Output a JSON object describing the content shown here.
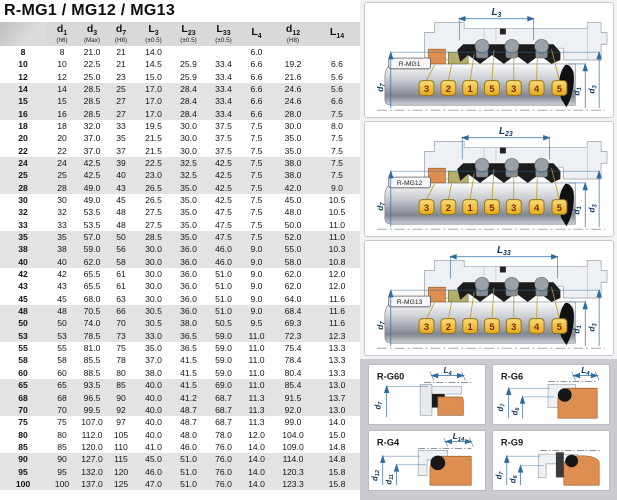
{
  "title": "R-MG1 / MG12 / MG13",
  "table": {
    "headers": [
      {
        "sym": "",
        "sub": "",
        "note": ""
      },
      {
        "sym": "d",
        "sub": "1",
        "note": "(h6)"
      },
      {
        "sym": "d",
        "sub": "3",
        "note": "(Max)"
      },
      {
        "sym": "d",
        "sub": "7",
        "note": "(H8)"
      },
      {
        "sym": "L",
        "sub": "3",
        "note": "(±0.5)"
      },
      {
        "sym": "L",
        "sub": "23",
        "note": "(±0.5)"
      },
      {
        "sym": "L",
        "sub": "33",
        "note": "(±0.5)"
      },
      {
        "sym": "L",
        "sub": "4",
        "note": ""
      },
      {
        "sym": "d",
        "sub": "12",
        "note": "(H8)"
      },
      {
        "sym": "L",
        "sub": "14",
        "note": ""
      }
    ],
    "rows": [
      [
        "8",
        "8",
        "21.0",
        "21",
        "14.0",
        "",
        "",
        "6.0",
        "",
        ""
      ],
      [
        "10",
        "10",
        "22.5",
        "21",
        "14.5",
        "25.9",
        "33.4",
        "6.6",
        "19.2",
        "6.6"
      ],
      [
        "12",
        "12",
        "25.0",
        "23",
        "15.0",
        "25.9",
        "33.4",
        "6.6",
        "21.6",
        "5.6"
      ],
      [
        "14",
        "14",
        "28.5",
        "25",
        "17.0",
        "28.4",
        "33.4",
        "6.6",
        "24.6",
        "5.6"
      ],
      [
        "15",
        "15",
        "28.5",
        "27",
        "17.0",
        "28.4",
        "33.4",
        "6.6",
        "24.6",
        "6.6"
      ],
      [
        "16",
        "16",
        "28.5",
        "27",
        "17.0",
        "28.4",
        "33.4",
        "6.6",
        "28.0",
        "7.5"
      ],
      [
        "18",
        "18",
        "32.0",
        "33",
        "19.5",
        "30.0",
        "37.5",
        "7.5",
        "30.0",
        "8.0"
      ],
      [
        "20",
        "20",
        "37.0",
        "35",
        "21.5",
        "30.0",
        "37.5",
        "7.5",
        "35.0",
        "7.5"
      ],
      [
        "22",
        "22",
        "37.0",
        "37",
        "21.5",
        "30.0",
        "37.5",
        "7.5",
        "35.0",
        "7.5"
      ],
      [
        "24",
        "24",
        "42.5",
        "39",
        "22.5",
        "32.5",
        "42.5",
        "7.5",
        "38.0",
        "7.5"
      ],
      [
        "25",
        "25",
        "42.5",
        "40",
        "23.0",
        "32.5",
        "42.5",
        "7.5",
        "38.0",
        "7.5"
      ],
      [
        "28",
        "28",
        "49.0",
        "43",
        "26.5",
        "35.0",
        "42.5",
        "7.5",
        "42.0",
        "9.0"
      ],
      [
        "30",
        "30",
        "49.0",
        "45",
        "26.5",
        "35.0",
        "42.5",
        "7.5",
        "45.0",
        "10.5"
      ],
      [
        "32",
        "32",
        "53.5",
        "48",
        "27.5",
        "35.0",
        "47.5",
        "7.5",
        "48.0",
        "10.5"
      ],
      [
        "33",
        "33",
        "53.5",
        "48",
        "27.5",
        "35.0",
        "47.5",
        "7.5",
        "50.0",
        "11.0"
      ],
      [
        "35",
        "35",
        "57.0",
        "50",
        "28.5",
        "35.0",
        "47.5",
        "7.5",
        "52.0",
        "11.0"
      ],
      [
        "38",
        "38",
        "59.0",
        "56",
        "30.0",
        "36.0",
        "46.0",
        "9.0",
        "55.0",
        "10.3"
      ],
      [
        "40",
        "40",
        "62.0",
        "58",
        "30.0",
        "36.0",
        "46.0",
        "9.0",
        "58.0",
        "10.8"
      ],
      [
        "42",
        "42",
        "65.5",
        "61",
        "30.0",
        "36.0",
        "51.0",
        "9.0",
        "62.0",
        "12.0"
      ],
      [
        "43",
        "43",
        "65.5",
        "61",
        "30.0",
        "36.0",
        "51.0",
        "9.0",
        "62.0",
        "12.0"
      ],
      [
        "45",
        "45",
        "68.0",
        "63",
        "30.0",
        "36.0",
        "51.0",
        "9.0",
        "64.0",
        "11.6"
      ],
      [
        "48",
        "48",
        "70.5",
        "66",
        "30.5",
        "36.0",
        "51.0",
        "9.0",
        "68.4",
        "11.6"
      ],
      [
        "50",
        "50",
        "74.0",
        "70",
        "30.5",
        "38.0",
        "50.5",
        "9.5",
        "69.3",
        "11.6"
      ],
      [
        "53",
        "53",
        "78.5",
        "73",
        "33.0",
        "36.5",
        "59.0",
        "11.0",
        "72.3",
        "12.3"
      ],
      [
        "55",
        "55",
        "81.0",
        "75",
        "35.0",
        "36.5",
        "59.0",
        "11.0",
        "75.4",
        "13.3"
      ],
      [
        "58",
        "58",
        "85.5",
        "78",
        "37.0",
        "41.5",
        "59.0",
        "11.0",
        "78.4",
        "13.3"
      ],
      [
        "60",
        "60",
        "88.5",
        "80",
        "38.0",
        "41.5",
        "59.0",
        "11.0",
        "80.4",
        "13.3"
      ],
      [
        "65",
        "65",
        "93.5",
        "85",
        "40.0",
        "41.5",
        "69.0",
        "11.0",
        "85.4",
        "13.0"
      ],
      [
        "68",
        "68",
        "96.5",
        "90",
        "40.0",
        "41.2",
        "68.7",
        "11.3",
        "91.5",
        "13.7"
      ],
      [
        "70",
        "70",
        "99.5",
        "92",
        "40.0",
        "48.7",
        "68.7",
        "11.3",
        "92.0",
        "13.0"
      ],
      [
        "75",
        "75",
        "107.0",
        "97",
        "40.0",
        "48.7",
        "68.7",
        "11.3",
        "99.0",
        "14.0"
      ],
      [
        "80",
        "80",
        "112.0",
        "105",
        "40.0",
        "48.0",
        "78.0",
        "12.0",
        "104.0",
        "15.0"
      ],
      [
        "85",
        "85",
        "120.0",
        "110",
        "41.0",
        "46.0",
        "76.0",
        "14.0",
        "109.0",
        "14.8"
      ],
      [
        "90",
        "90",
        "127.0",
        "115",
        "45.0",
        "51.0",
        "76.0",
        "14.0",
        "114.0",
        "14.8"
      ],
      [
        "95",
        "95",
        "132.0",
        "120",
        "46.0",
        "51.0",
        "76.0",
        "14.0",
        "120.3",
        "15.8"
      ],
      [
        "100",
        "100",
        "137.0",
        "125",
        "47.0",
        "51.0",
        "76.0",
        "14.0",
        "123.3",
        "15.8"
      ]
    ]
  },
  "diagrams": [
    {
      "label": "R-MG1",
      "dim_sym": "L",
      "dim_sub": "3",
      "left_sym": "d",
      "left_sub": "7",
      "r1_sym": "d",
      "r1_sub": "1",
      "r2_sym": "d",
      "r2_sub": "3",
      "balloons": [
        "3",
        "2",
        "1",
        "5",
        "3",
        "4",
        "5"
      ]
    },
    {
      "label": "R-MG12",
      "dim_sym": "L",
      "dim_sub": "23",
      "left_sym": "d",
      "left_sub": "7",
      "r1_sym": "d",
      "r1_sub": "1",
      "r2_sym": "d",
      "r2_sub": "3",
      "balloons": [
        "3",
        "2",
        "1",
        "5",
        "3",
        "4",
        "5"
      ]
    },
    {
      "label": "R-MG13",
      "dim_sym": "L",
      "dim_sub": "33",
      "left_sym": "d",
      "left_sub": "7",
      "r1_sym": "d",
      "r1_sub": "1",
      "r2_sym": "d",
      "r2_sub": "3",
      "balloons": [
        "3",
        "2",
        "1",
        "5",
        "3",
        "4",
        "5"
      ]
    }
  ],
  "detail_panels": [
    {
      "label": "R-G60",
      "top_sym": "L",
      "top_sub": "4",
      "left1_sym": "d",
      "left1_sub": "7",
      "left2_sym": "",
      "left2_sub": ""
    },
    {
      "label": "R-G6",
      "top_sym": "L",
      "top_sub": "4",
      "left1_sym": "d",
      "left1_sub": "7",
      "left2_sym": "d",
      "left2_sub": "6"
    },
    {
      "label": "R-G4",
      "top_sym": "L",
      "top_sub": "14",
      "left1_sym": "d",
      "left1_sub": "12",
      "left2_sym": "d",
      "left2_sub": "11"
    },
    {
      "label": "R-G9",
      "top_sym": "",
      "top_sub": "",
      "left1_sym": "d",
      "left1_sub": "7",
      "left2_sym": "d",
      "left2_sub": "6"
    }
  ],
  "colors": {
    "dimension_blue": "#2d6ba3",
    "balloon_gold": "#efb92c",
    "seat_orange": "#dd8e50",
    "ring_olive": "#b3ae6b",
    "header_gray": "#d9d9d9",
    "band_gray": "#e3e3e3",
    "bottom_panel_gray": "#c9cbd0"
  }
}
